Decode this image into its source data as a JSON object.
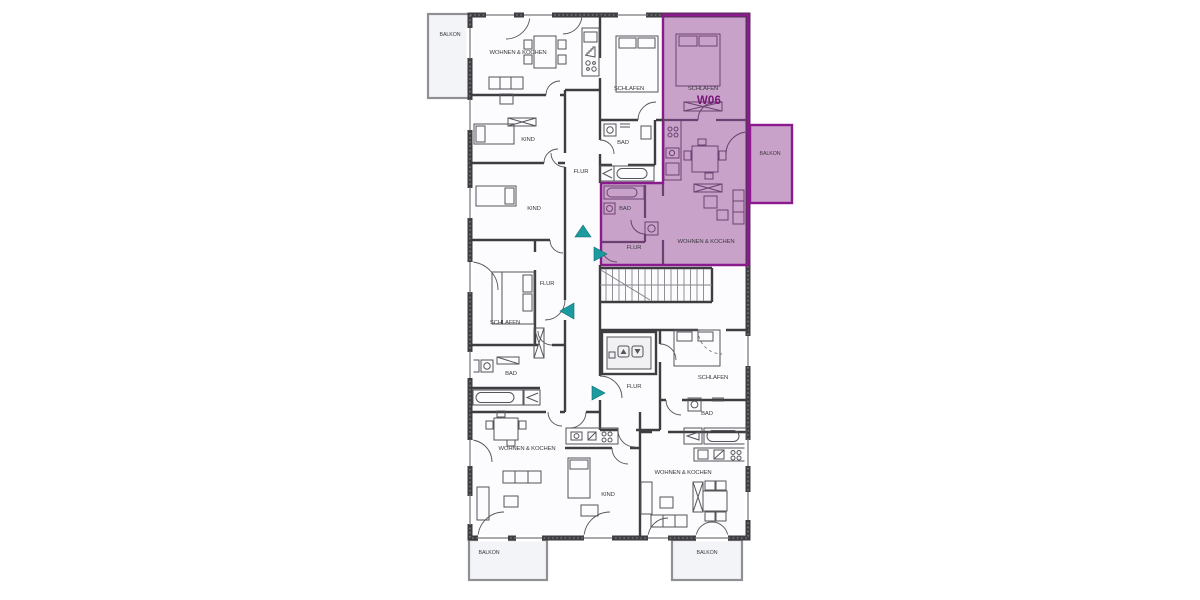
{
  "plan": {
    "type": "apartment-floor-plan",
    "unit": {
      "id": "W06",
      "highlight_fill": "#c9a2ca",
      "highlight_border": "#8a1b8c",
      "label_color": "#771677"
    },
    "entrance_marker_color": "#1b9b9f",
    "wall_color": "#3d3d42",
    "rooms": {
      "balkon": "BALKON",
      "wohnen_kochen": "WOHNEN & KOCHEN",
      "schlafen": "SCHLAFEN",
      "kind": "KIND",
      "bad": "BAD",
      "flur": "FLUR"
    }
  }
}
